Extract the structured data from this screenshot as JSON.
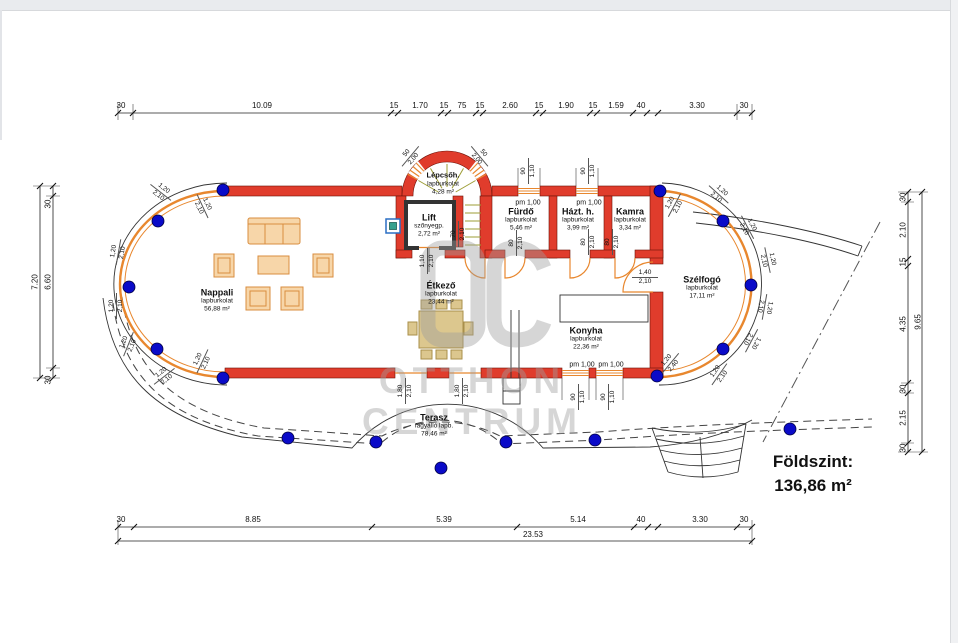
{
  "title_block": {
    "floor_label": "Földszint:",
    "floor_area": "136,86 m²"
  },
  "watermark": {
    "monogram": "OC",
    "line1": "OTTHON",
    "line2": "CENTRUM"
  },
  "rooms": {
    "lepcso": {
      "name": "Lépcsőh.",
      "finish": "lapburkolat",
      "area": "4,28 m²"
    },
    "lift": {
      "name": "Lift",
      "finish": "szőnyegp.",
      "area": "2,72 m²"
    },
    "furdo": {
      "name": "Fürdő",
      "finish": "lapburkolat",
      "area": "5,46 m²"
    },
    "hazt": {
      "name": "Házt. h.",
      "finish": "lapburkolat",
      "area": "3,99 m²"
    },
    "kamra": {
      "name": "Kamra",
      "finish": "lapburkolat",
      "area": "3,34 m²"
    },
    "szelfogo": {
      "name": "Szélfogó",
      "finish": "lapburkolat",
      "area": "17,11 m²"
    },
    "nappali": {
      "name": "Nappali",
      "finish": "lapburkolat",
      "area": "56,88 m²"
    },
    "etkezo": {
      "name": "Étkező",
      "finish": "lapburkolat",
      "area": "23,44 m²"
    },
    "konyha": {
      "name": "Konyha",
      "finish": "lapburkolat",
      "area": "22,36 m²"
    },
    "terasz": {
      "name": "Terasz",
      "finish": "fagyálló lapb.",
      "area": "78,46 m²"
    }
  },
  "dims": {
    "top": [
      "30",
      "10.09",
      "15",
      "1.70",
      "15",
      "75",
      "15",
      "2.60",
      "15",
      "1.90",
      "15",
      "1.59",
      "40",
      "3.30",
      "30"
    ],
    "bottom": [
      "30",
      "8.85",
      "5.39",
      "5.14",
      "40",
      "3.30",
      "30"
    ],
    "bottom_total": "23.53",
    "left_outer": "7.20",
    "left": [
      "30",
      "6.60",
      "30"
    ],
    "right_outer": "9.65",
    "right": [
      "30",
      "2.10",
      "15",
      "4.35",
      "30",
      "2.15",
      "30"
    ]
  },
  "openings": [
    {
      "w": "1,20",
      "h": "2,10"
    },
    {
      "w": "1,20",
      "h": "2,10"
    },
    {
      "w": "1,20",
      "h": "2,10"
    },
    {
      "w": "1,20",
      "h": "2,10"
    },
    {
      "w": "1,20",
      "h": "2,10"
    },
    {
      "w": "1,20",
      "h": "2,10"
    },
    {
      "w": "1,20",
      "h": "2,10"
    },
    {
      "w": "1,20",
      "h": "2,10"
    },
    {
      "w": "1,20",
      "h": "2,10"
    },
    {
      "w": "1,20",
      "h": "2,10"
    },
    {
      "w": "1,20",
      "h": "2,10"
    },
    {
      "w": "1,20",
      "h": "2,10"
    },
    {
      "w": "1,20",
      "h": "2,10"
    },
    {
      "w": "1,20",
      "h": "2,40"
    },
    {
      "w": "1,20",
      "h": "2,10"
    },
    {
      "w": "1,80",
      "h": "2,10"
    },
    {
      "w": "1,80",
      "h": "2,10"
    },
    {
      "w": "1,10",
      "h": "2,10"
    },
    {
      "w": "70",
      "h": "2,10"
    },
    {
      "w": "80",
      "h": "2,10"
    },
    {
      "w": "80",
      "h": "2,10"
    },
    {
      "w": "80",
      "h": "2,10"
    },
    {
      "w": "1,40",
      "h": "2,10"
    },
    {
      "w": "90",
      "h": "1,10"
    },
    {
      "w": "90",
      "h": "1,10"
    },
    {
      "w": "90",
      "h": "1,10"
    },
    {
      "w": "90",
      "h": "1,10"
    },
    {
      "w": "50",
      "h": "2,00"
    },
    {
      "w": "50",
      "h": "2,00"
    }
  ],
  "pm_tags": [
    "pm 1,00",
    "pm 1,00",
    "pm 1,00",
    "pm 1,00"
  ],
  "colors": {
    "wall": "#e03c2c",
    "glass": "#e8872e",
    "marker": "#0a0ac8",
    "furniture": "#f7d6a9",
    "dining": "#dcc78e",
    "stairs": "#9d9d35",
    "watermark": "#9e9e9e"
  }
}
